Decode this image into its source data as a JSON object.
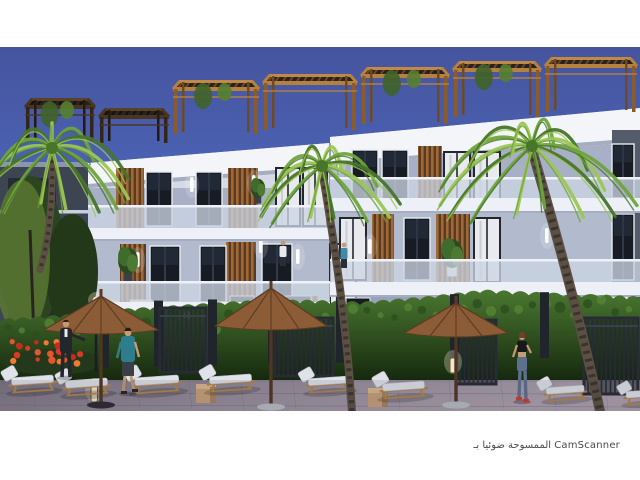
{
  "footer": {
    "text": "الممسوحة ضوئيا بـ CamScanner"
  },
  "photo": {
    "x": 0,
    "y": 47,
    "width": 640,
    "height": 364,
    "caption": "architectural rendering of a modern white apartment complex at dusk with rooftop pergolas, palm trees, hedge walls, pool-side umbrellas, sun loungers and people"
  },
  "colors": {
    "sky_top": "#46549e",
    "sky_mid": "#4d68bd",
    "sky_bot": "#7187d2",
    "wall_bright": "#f3f5f9",
    "wall_light": "#e2e7f0",
    "wall_mid": "#d5dae6",
    "recess_a": "#a7b0c6",
    "recess_b": "#b2bace",
    "ground_wall": "#99a2b8",
    "dark_side": "#3d4452",
    "slab": "#edf0f6",
    "slab_shadow": "#a6adc0",
    "balustrade": "#ccd5e3",
    "balustrade_rail": "#eef2f8",
    "win_dark": "#171b24",
    "win_frame": "#e8ecf2",
    "win_mullion": "#3c4454",
    "curtain": "#e9eaee",
    "curtain_frame": "#23262e",
    "wood_hi": "#b5813f",
    "wood_md": "#8a5c2c",
    "wood_dk": "#4c3118",
    "deck": "#241a10",
    "slat_a": "#a06a38",
    "slat_b": "#5a3a20",
    "hedge_hi": "#4a7830",
    "hedge_lo": "#16290f",
    "gate": "#272b33",
    "ground_hi": "#aaa0ad",
    "ground_lo": "#6f6a79",
    "pave_line": "#5c5766",
    "umb": "#8b5c36",
    "umb_dk": "#5d3b22",
    "pole": "#4f3620",
    "cushion": "#dfe3e9",
    "lounger_wood": "#b28449",
    "fl_red": "#d93a26",
    "fl_org": "#ee7a33",
    "fl_base": "#24381c",
    "palm_hi": "#9cc653",
    "palm_md": "#6fa33c",
    "palm_dk": "#47752a",
    "trunk": "#5c5044",
    "trunk_dk": "#3b342c",
    "skin": "#c49a77",
    "teal": "#2e7d8c",
    "suit": "#23262c",
    "jeans": "#5e718c",
    "shoe_red": "#d5382e",
    "white_shirt": "#e8e9ec",
    "glow": "#fff3d8"
  },
  "scene": {
    "pergolas": [
      {
        "x0": 25,
        "x1": 95,
        "top": 98,
        "base": 141,
        "tone": "dark",
        "vine": true
      },
      {
        "x0": 99,
        "x1": 169,
        "top": 108,
        "base": 143,
        "tone": "dark",
        "vine": false
      },
      {
        "x0": 173,
        "x1": 259,
        "top": 80,
        "base": 134,
        "tone": "amber",
        "vine": true
      },
      {
        "x0": 263,
        "x1": 357,
        "top": 74,
        "base": 130,
        "tone": "amber",
        "vine": false
      },
      {
        "x0": 361,
        "x1": 449,
        "top": 67,
        "base": 124,
        "tone": "amber",
        "vine": true
      },
      {
        "x0": 453,
        "x1": 541,
        "top": 61,
        "base": 117,
        "tone": "amber",
        "vine": true
      },
      {
        "x0": 545,
        "x1": 637,
        "top": 57,
        "base": 112,
        "tone": "amber",
        "vine": false
      }
    ],
    "windows": [
      {
        "x": 146,
        "y": 172,
        "w": 26,
        "h": 54,
        "type": "dark"
      },
      {
        "x": 196,
        "y": 172,
        "w": 26,
        "h": 54,
        "type": "dark"
      },
      {
        "x": 276,
        "y": 168,
        "w": 24,
        "h": 58,
        "type": "curtain"
      },
      {
        "x": 303,
        "y": 168,
        "w": 24,
        "h": 58,
        "type": "curtain"
      },
      {
        "x": 150,
        "y": 246,
        "w": 30,
        "h": 56,
        "type": "dark"
      },
      {
        "x": 200,
        "y": 246,
        "w": 26,
        "h": 56,
        "type": "dark"
      },
      {
        "x": 262,
        "y": 244,
        "w": 30,
        "h": 58,
        "type": "dark"
      },
      {
        "x": 330,
        "y": 244,
        "w": 26,
        "h": 60,
        "type": "curtain"
      },
      {
        "x": 352,
        "y": 150,
        "w": 26,
        "h": 50,
        "type": "dark"
      },
      {
        "x": 382,
        "y": 150,
        "w": 26,
        "h": 50,
        "type": "dark"
      },
      {
        "x": 444,
        "y": 152,
        "w": 26,
        "h": 48,
        "type": "curtain"
      },
      {
        "x": 474,
        "y": 152,
        "w": 26,
        "h": 48,
        "type": "curtain"
      },
      {
        "x": 340,
        "y": 218,
        "w": 26,
        "h": 62,
        "type": "curtain"
      },
      {
        "x": 404,
        "y": 218,
        "w": 26,
        "h": 62,
        "type": "dark"
      },
      {
        "x": 474,
        "y": 218,
        "w": 26,
        "h": 64,
        "type": "curtain"
      },
      {
        "x": 612,
        "y": 144,
        "w": 22,
        "h": 54,
        "type": "dark"
      },
      {
        "x": 612,
        "y": 214,
        "w": 22,
        "h": 66,
        "type": "dark"
      }
    ],
    "slats": [
      {
        "x": 116,
        "y": 168,
        "w": 28,
        "h": 60
      },
      {
        "x": 228,
        "y": 168,
        "w": 30,
        "h": 60
      },
      {
        "x": 120,
        "y": 244,
        "w": 26,
        "h": 60
      },
      {
        "x": 226,
        "y": 242,
        "w": 30,
        "h": 62
      },
      {
        "x": 418,
        "y": 146,
        "w": 24,
        "h": 56
      },
      {
        "x": 372,
        "y": 214,
        "w": 22,
        "h": 70
      },
      {
        "x": 436,
        "y": 214,
        "w": 34,
        "h": 70
      },
      {
        "x": 296,
        "y": 296,
        "w": 22,
        "h": 50
      }
    ],
    "sconces": [
      {
        "x": 190,
        "y": 177
      },
      {
        "x": 252,
        "y": 175
      },
      {
        "x": 259,
        "y": 238
      },
      {
        "x": 136,
        "y": 252
      },
      {
        "x": 296,
        "y": 249
      },
      {
        "x": 368,
        "y": 239
      },
      {
        "x": 337,
        "y": 158
      },
      {
        "x": 545,
        "y": 228
      }
    ],
    "ground_windows": [
      {
        "x": 96,
        "y": 300,
        "w": 22,
        "h": 28,
        "lit": true
      },
      {
        "x": 130,
        "y": 300,
        "w": 22,
        "h": 28,
        "lit": true
      },
      {
        "x": 230,
        "y": 296,
        "w": 24,
        "h": 34,
        "lit": false
      },
      {
        "x": 285,
        "y": 296,
        "w": 26,
        "h": 34,
        "lit": false
      },
      {
        "x": 346,
        "y": 298,
        "w": 24,
        "h": 34,
        "lit": false
      },
      {
        "x": 418,
        "y": 300,
        "w": 22,
        "h": 30,
        "lit": true
      },
      {
        "x": 452,
        "y": 300,
        "w": 22,
        "h": 30,
        "lit": true
      },
      {
        "x": 520,
        "y": 300,
        "w": 20,
        "h": 30,
        "lit": false
      },
      {
        "x": 610,
        "y": 296,
        "w": 18,
        "h": 30,
        "lit": true
      }
    ],
    "plants": [
      {
        "x": 128,
        "y": 252,
        "s": 1.1,
        "pot": "#3a3f48"
      },
      {
        "x": 258,
        "y": 182,
        "s": 0.8,
        "pot": "#3a3f48"
      },
      {
        "x": 452,
        "y": 244,
        "s": 1.2,
        "pot": "#e8e8e8"
      }
    ],
    "gates": [
      {
        "x": 160,
        "y": 308,
        "w": 46,
        "h": 64
      },
      {
        "x": 275,
        "y": 318,
        "w": 58,
        "h": 58
      },
      {
        "x": 456,
        "y": 320,
        "w": 40,
        "h": 64
      },
      {
        "x": 584,
        "y": 318,
        "w": 54,
        "h": 76
      }
    ],
    "pillars": [
      100,
      154,
      208,
      268,
      336,
      450,
      540
    ],
    "stools": [
      {
        "x": 196,
        "y": 384
      },
      {
        "x": 368,
        "y": 388
      }
    ],
    "bollards": [
      {
        "x": 91,
        "y": 386,
        "h": 16
      },
      {
        "x": 450,
        "y": 358,
        "h": 15
      }
    ],
    "loungers": [
      {
        "x": 8,
        "y": 376,
        "s": 1.05
      },
      {
        "x": 62,
        "y": 379,
        "s": 1.05
      },
      {
        "x": 131,
        "y": 376,
        "s": 1.1
      },
      {
        "x": 206,
        "y": 375,
        "s": 1.05
      },
      {
        "x": 305,
        "y": 377,
        "s": 1.0
      },
      {
        "x": 379,
        "y": 382,
        "s": 1.05
      },
      {
        "x": 543,
        "y": 386,
        "s": 0.95
      },
      {
        "x": 623,
        "y": 390,
        "s": 0.92
      }
    ],
    "umbrellas": [
      {
        "cx": 101,
        "apex": 296,
        "rim": 330,
        "hw": 57,
        "poleB": 402,
        "base": "dark"
      },
      {
        "cx": 271,
        "apex": 288,
        "rim": 326,
        "hw": 56,
        "poleB": 404,
        "base": "light"
      },
      {
        "cx": 456,
        "apex": 303,
        "rim": 333,
        "hw": 52,
        "poleB": 402,
        "base": "light"
      }
    ],
    "palms": [
      {
        "cx": 52,
        "cy": 148,
        "len": 88,
        "n": 13,
        "tx": 40,
        "ty": 270,
        "tw": 7
      },
      {
        "cx": 322,
        "cy": 166,
        "len": 74,
        "n": 12,
        "tx": 352,
        "ty": 411,
        "tw": 8
      },
      {
        "cx": 532,
        "cy": 146,
        "len": 97,
        "n": 14,
        "tx": 600,
        "ty": 411,
        "tw": 10
      }
    ],
    "people": [
      {
        "type": "suit",
        "x": 66,
        "y": 377
      },
      {
        "type": "teal",
        "x": 128,
        "y": 393
      },
      {
        "type": "jogger",
        "x": 522,
        "y": 401
      },
      {
        "type": "balcony",
        "x": 283,
        "y": 266,
        "shirt": "#e8e9ec"
      },
      {
        "type": "balcony",
        "x": 344,
        "y": 268,
        "shirt": "#3e8aa8"
      }
    ],
    "flowers": {
      "x0": 10,
      "x1": 95,
      "yTop": 340,
      "yBot": 364,
      "count": 22
    }
  }
}
